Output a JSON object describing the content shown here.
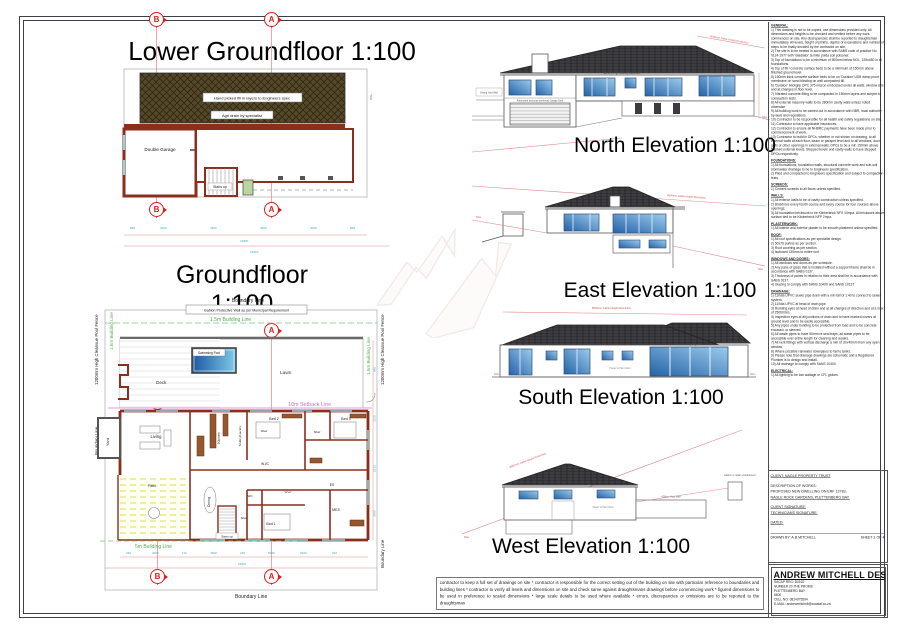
{
  "markers": {
    "a": "A",
    "b": "B"
  },
  "lower": {
    "title": "Lower Groundfloor 1:100",
    "fill_note": "Hand picked fill in layers to Engineers spec",
    "agri_note": "Agri drain by specialist",
    "garage": "Double Garage",
    "stairs": "Stairs up",
    "ngl": "NGL",
    "dims": [
      "890",
      "4000",
      "4300",
      "4300",
      "4000",
      "890"
    ],
    "total1": "21800",
    "total2": "24810"
  },
  "ground": {
    "title": "Groundfloor 1:100",
    "boundary": "Boundary Line",
    "gabion": "Gabion Protective Wall as per Municipal Requirement",
    "bl15": "1.5m Building Line",
    "bl5": "5m Building Line",
    "setback": "10m Setback Line",
    "fence": "1200mm High Cleanvue Pool Fence",
    "pool": "Swimming Pool",
    "lawn": "Lawn",
    "deck": "Deck",
    "yard": "Yard",
    "rooms": {
      "living": "Living",
      "patio": "Patio",
      "dining": "Dining",
      "kitchen": "Kitchen",
      "scullery": "Scullery/Laundry",
      "shwr": "Shwr",
      "bed1": "Bed 1",
      "bed2": "Bed 2",
      "bed3": "Bed 3",
      "wic": "W.I/C",
      "wc": "WC",
      "wpc": "W+C",
      "es": "ES",
      "mes": "MES",
      "stairs": "Stairs up"
    },
    "dims_bottom": [
      "240",
      "4000",
      "110",
      "4300",
      "240",
      "5080",
      "2400",
      "240"
    ],
    "total": "21800",
    "dims_right": [
      "890",
      "3120",
      "2230",
      "3400"
    ]
  },
  "elev": {
    "annotation": "8500mm Gable Height Restriction",
    "ngl": "NGL",
    "north": {
      "title": "North Elevation 1:100",
      "yard_wall": "Drying Yard Wall",
      "balustrade": "1800mm High Masonry Balustrade",
      "garage_note": "Automated sectional overhead Garage Door"
    },
    "east": {
      "title": "East Elevation 1:100"
    },
    "south": {
      "title": "South Elevation 1:100",
      "slider_note": "Stack Sliders by Engineer",
      "finish_note": "Plaster & Paint finish"
    },
    "west": {
      "title": "West Elevation 1:100",
      "wall_note": "600mm High Wall",
      "gabion_note": "Gabion to retain embankment",
      "finish_note": "Plaster & Paint finish"
    }
  },
  "notes": {
    "sections": [
      {
        "heading": "GENERAL:",
        "lines": [
          "1) This drawing is not to be copied, use dimensions provided only. All dimensions and heights to be checked and verified before any work commences on site. Any discrepancies shall be reported to draughtsman immediately. All levels, height of plinths, depths of excavations and number of steps to be finally decided by the contractor on site.",
          "2) The site is to be treated in accordance with SABS code of practice No. 0124-1977 with 'Gladiator' termite poida soil poisoner.",
          "3) Top of foundations to be a minimum of 500mm below NGL, 225x450 in all foundations.",
          "4) Top of fill / concrete surface beds to be a minimum of 150mm above finished ground level.",
          "5) 150mm thick concrete surface beds to be on 'Duraton' USB damp proof membrane on sand blinding on well compacted fill.",
          "6) 'Duraton' brickgrip DPC 375 micron embossed under all walls, window sills and at changes in floor level.",
          "7) Vibrated concrete filling to be compacted in 150mm layers and subject to compaction tests.",
          "8) All external masonry walls to be 280mm cavity walls unless noted otherwise.",
          "9) All building work to be carried out in accordance with NBR, local authority by-laws and regulations.",
          "10) Contractor to be responsible for all health and safety regulations on site.",
          "11) Contractor to have applicable insurances.",
          "12) Contractor to ensure all NHBRC payments have been made prior to commencement of work.",
          "13) Contractor to build in DPCs, whether or not shown on drawing, to all external walls at each floor, beam or parapet level and to all windows, door grills or other openings in external walls. DPCs to be a min 150mm above finished external levels. Stepped levels and cavity walls to have stepped DPCs respectively."
        ]
      },
      {
        "heading": "FOUNDATIONS:",
        "lines": [
          "1) All foundations, foundation walls, structural concrete work and sub-soil stormwater drainage to be to Engineers specification.",
          "2) Piled and compacted to Engineers specification and subject to compaction tests."
        ]
      },
      {
        "heading": "SCREEDS:",
        "lines": [
          "1) Cement screeds to all floors unless specified."
        ]
      },
      {
        "heading": "WALLS:",
        "lines": [
          "1) All exterior walls to be of cavity construction unless specified.",
          "2) Brickforce every fourth course and every course for four courses above openings.",
          "3) All foundation brickwork to be Klinkerbrick NFX 10mpa. All brickwork above surface bed to be Klinkerbrick NFP 7mpa."
        ]
      },
      {
        "heading": "PLASTERWORK:",
        "lines": [
          "1) All interior and exterior plaster to be smooth plastered unless specified."
        ]
      },
      {
        "heading": "ROOF:",
        "lines": [
          "1) All roof specifications as per specialist design.",
          "2) 50x76 purlins as per section.",
          "3) Roof covering as per section.",
          "4) Isoboard 135mm to entire roof."
        ]
      },
      {
        "heading": "WINDOWS AND DOORS:",
        "lines": [
          "1) All windows and doors as per schedule.",
          "2) Any pane of glass that is installed without a support frame shall be in accordance with SABS 0137.",
          "3) Thickness of panes in relation to their area shall be in accordance with SABS 0137.",
          "4) Glazing to comply with SANS 10400 and SANS 10137."
        ]
      },
      {
        "heading": "DRAINAGE:",
        "lines": [
          "1) 110dia UPVC sewer pipe drain with a min fall of 1:40 to connect to sewer system.",
          "2) 110dia UPVC at head of drain pipe.",
          "3) Rodding eyes at head of drain and at all changes of direction and at a max of 25000mm.",
          "4) Inspection eyes at all junctions of drain and to have marked covers at ground level and to be easily accessible.",
          "5) Any pipes under building to be protected from load and to be concrete encased, or sleeved.",
          "6) All waste pipes to have 50mm re-seal traps, all waste pipes to be accessible over entire length for cleaning and repairs.",
          "7) All vent fittings with vertical discharge a min of 2m/40mm from any open window.",
          "8) Where possible rainwater downpipes to fall to tanks.",
          "9) Please note that drainage drawings are schematic and a Registered Plumber is to design and install.",
          "10) All drainage to comply with SANS 10400."
        ]
      },
      {
        "heading": "ELECTRICAL:",
        "lines": [
          "1) All lighting to be low wattage or CFL globes."
        ]
      }
    ]
  },
  "titleblock": {
    "client": "CLIENT: NAGLE PROPERTY TRUST",
    "desc_label": "DESCRIPTION OF WORKS:",
    "desc1": "PROPOSED NEW DWELLING ON ERF 12783,",
    "desc2": "NAGLE ROCK GARDENS, PLETTENBERG BAY.",
    "client_sig": "CLIENT SIGNATURE:",
    "tech_sig": "TECHNICIANS SIGNATURE:",
    "dated": "DATED:",
    "drawn": "DRAWN BY: A.B MITCHELL",
    "sheet": "SHEET 1 OF 4"
  },
  "company": {
    "name": "ANDREW MITCHELL DESIGNS",
    "reg": "SACAP REG: D0162",
    "addr1": "NUMBER 20 THE PROMS",
    "addr2": "PLETTENBERG BAY",
    "addr3": "6600",
    "cell": "CELL NO: 0824075594",
    "email": "E-MAIL: andrewmitchell@coastal.co.za"
  },
  "disclaimer": {
    "text": "contractor to keep a full set of drawings on site  *  contractor is responsible for the correct setting out of the building on site with particular reference to boundaries and building lines * contractor to verify all levels and dimensions on site and check same against draughtsmans drawings before commencing work * figured dimensions to be used in preference to scaled dimensions  * large scale details to be used where available  * errors, discrepancies or omissions are to be reported to the draughtsman"
  }
}
